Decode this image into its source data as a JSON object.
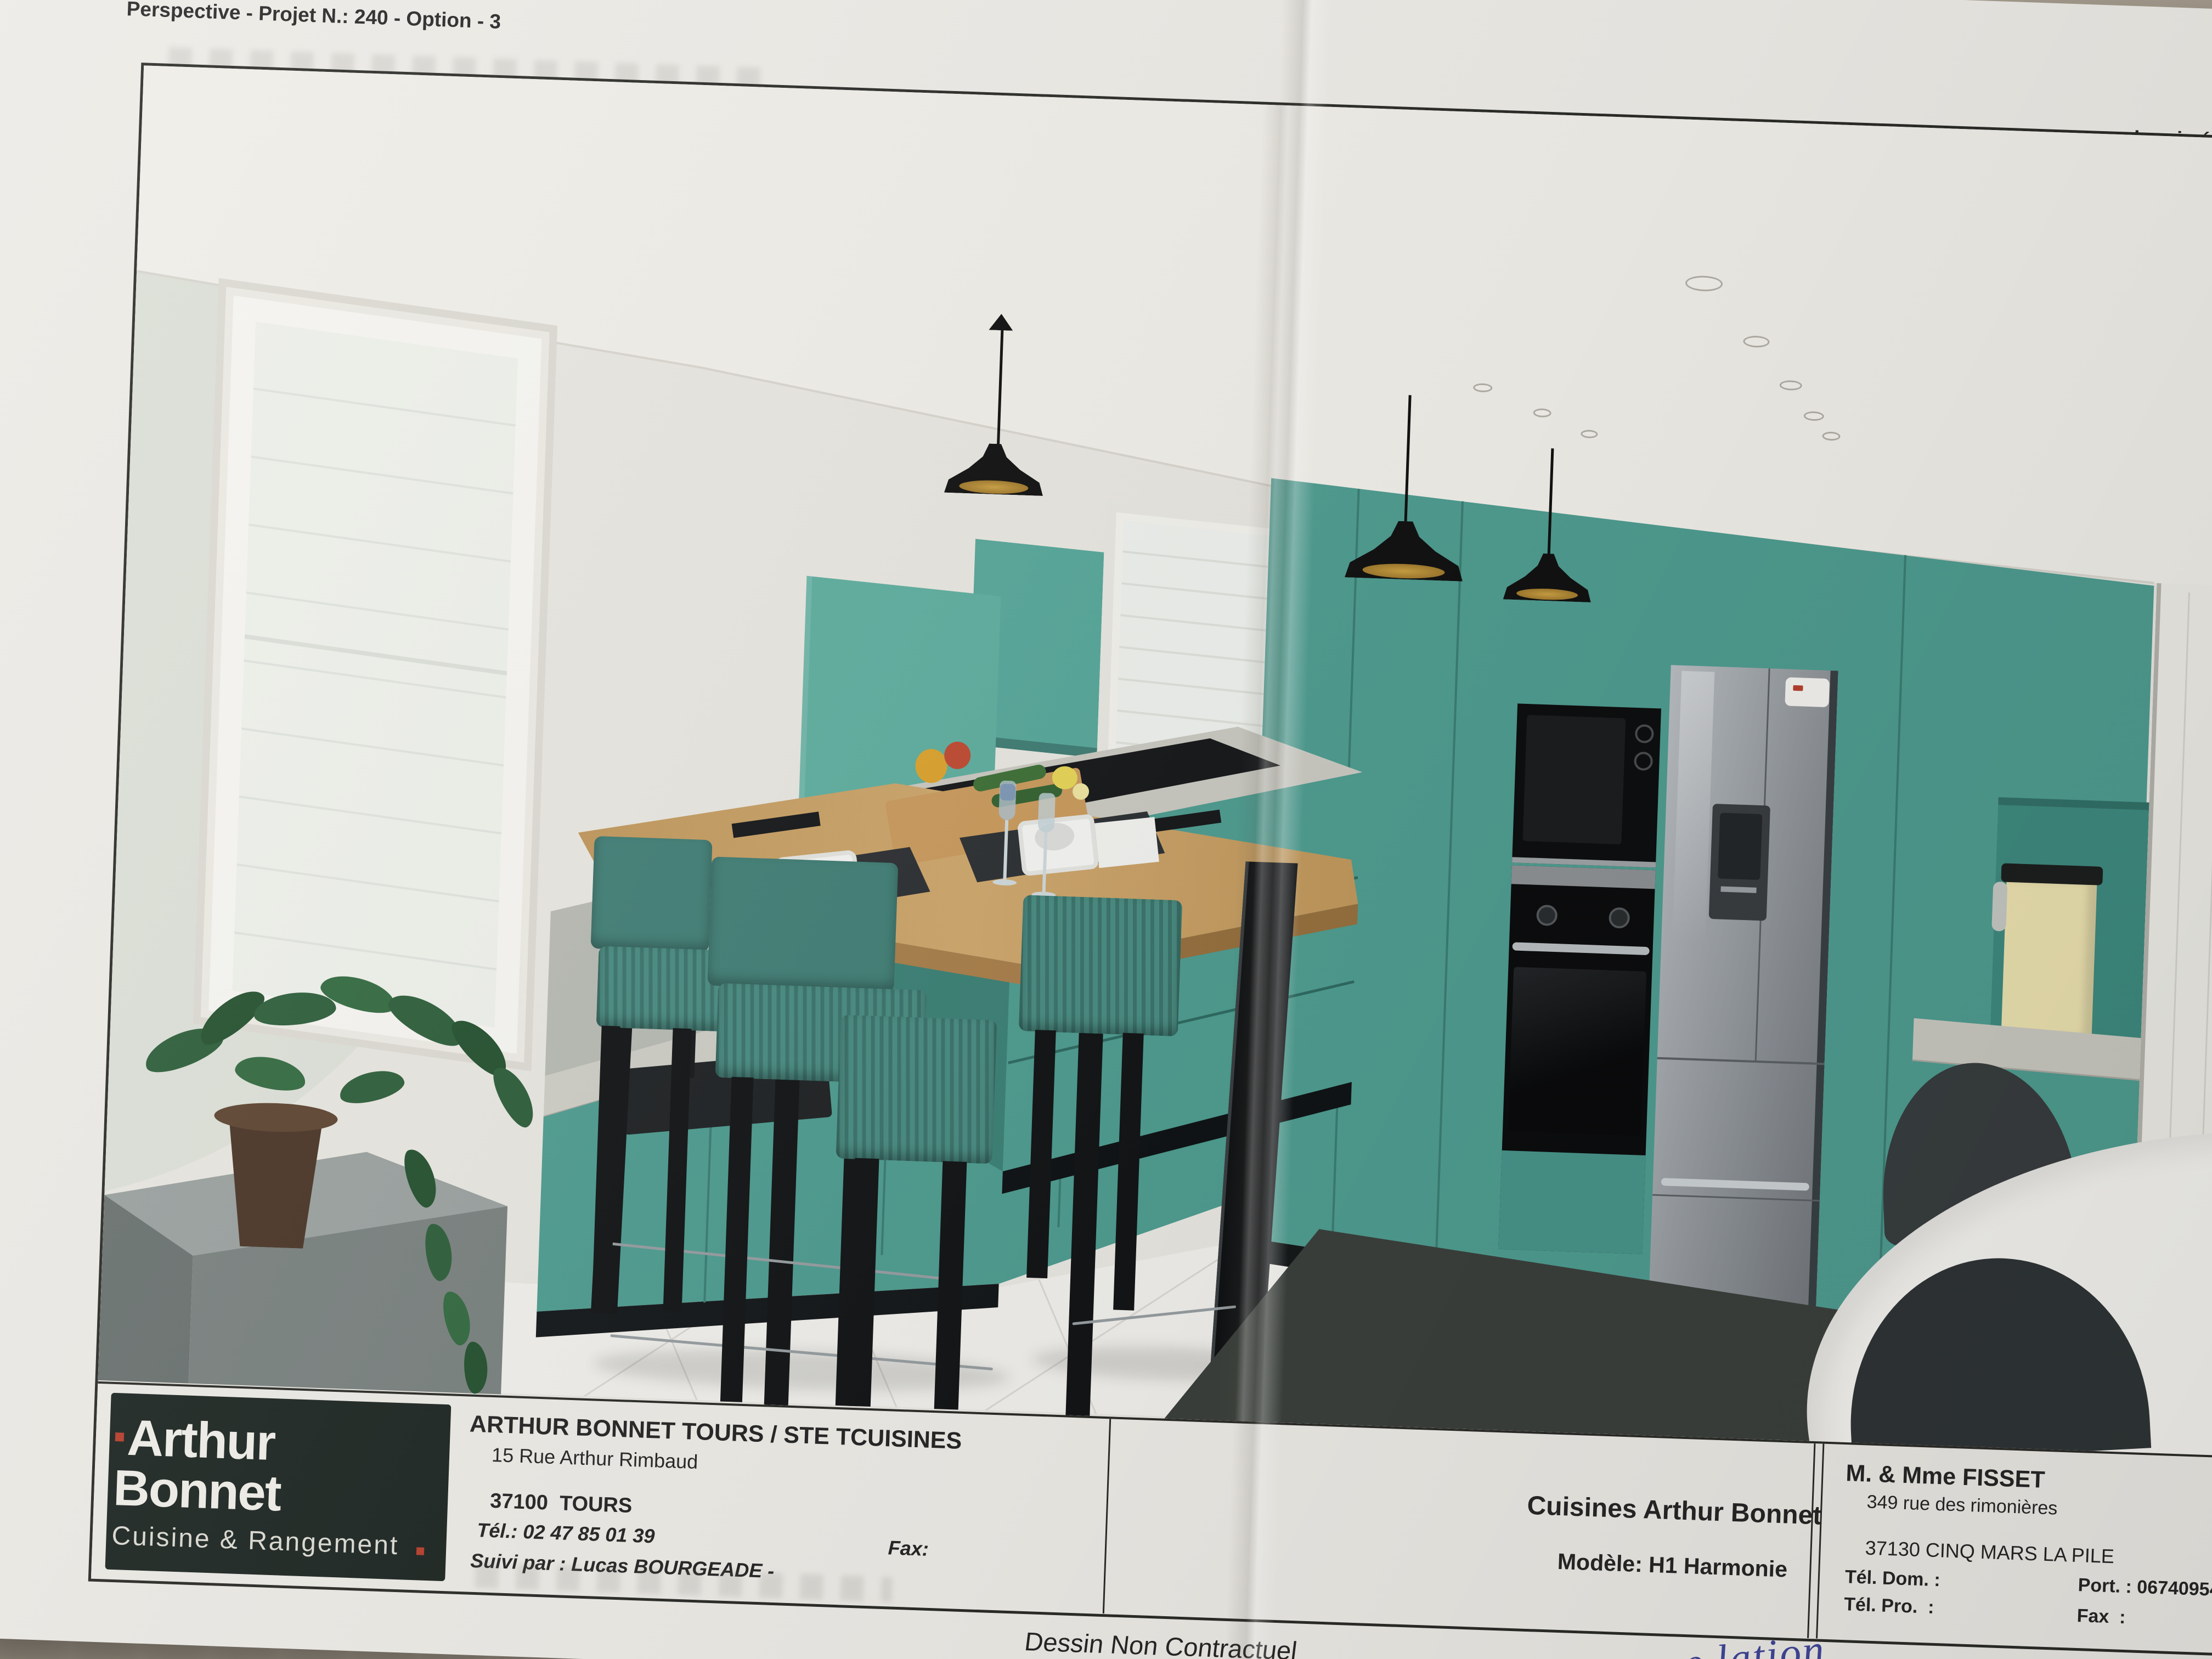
{
  "document": {
    "type_label": "Perspective - Projet N.: 240 - Option - 3",
    "printed_label": "Imprimé le 2"
  },
  "title_block": {
    "logo": {
      "brand": "Arthur Bonnet",
      "tagline": "Cuisine & Rangement"
    },
    "dealer": {
      "name": "ARTHUR BONNET TOURS / STE TCUISINES",
      "street": "15 Rue Arthur Rimbaud",
      "city": "37100  TOURS",
      "phone": "Tél.: 02 47 85 01 39",
      "fax": "Fax:",
      "followed_by": "Suivi par : Lucas BOURGEADE -"
    },
    "project": {
      "company": "Cuisines Arthur Bonnet",
      "model": "Modèle: H1 Harmonie"
    },
    "customer": {
      "name": "M. & Mme FISSET",
      "street": "349 rue des rimonières",
      "city": "37130 CINQ MARS LA PILE",
      "tel_dom": "Tél. Dom. :",
      "tel_pro": "Tél. Pro.  :",
      "port": "Port. : 0674095483",
      "fax": "Fax  :"
    }
  },
  "footer": {
    "disclaimer": "Dessin Non Contractuel",
    "handwriting": "e lation"
  },
  "colors": {
    "cabinet_teal": "#4f9c90",
    "cabinet_teal_light": "#5fae9f",
    "wood": "#c49b63",
    "bar_wood": "#c9a369",
    "paper": "#edebe6",
    "photo_background": "#b4ab9d",
    "logo_background": "#1e2723",
    "accent_red": "#b8402e",
    "appliance_black": "#111214",
    "fridge_silver": "#9aa0a5",
    "floor": "#f0efeb"
  }
}
